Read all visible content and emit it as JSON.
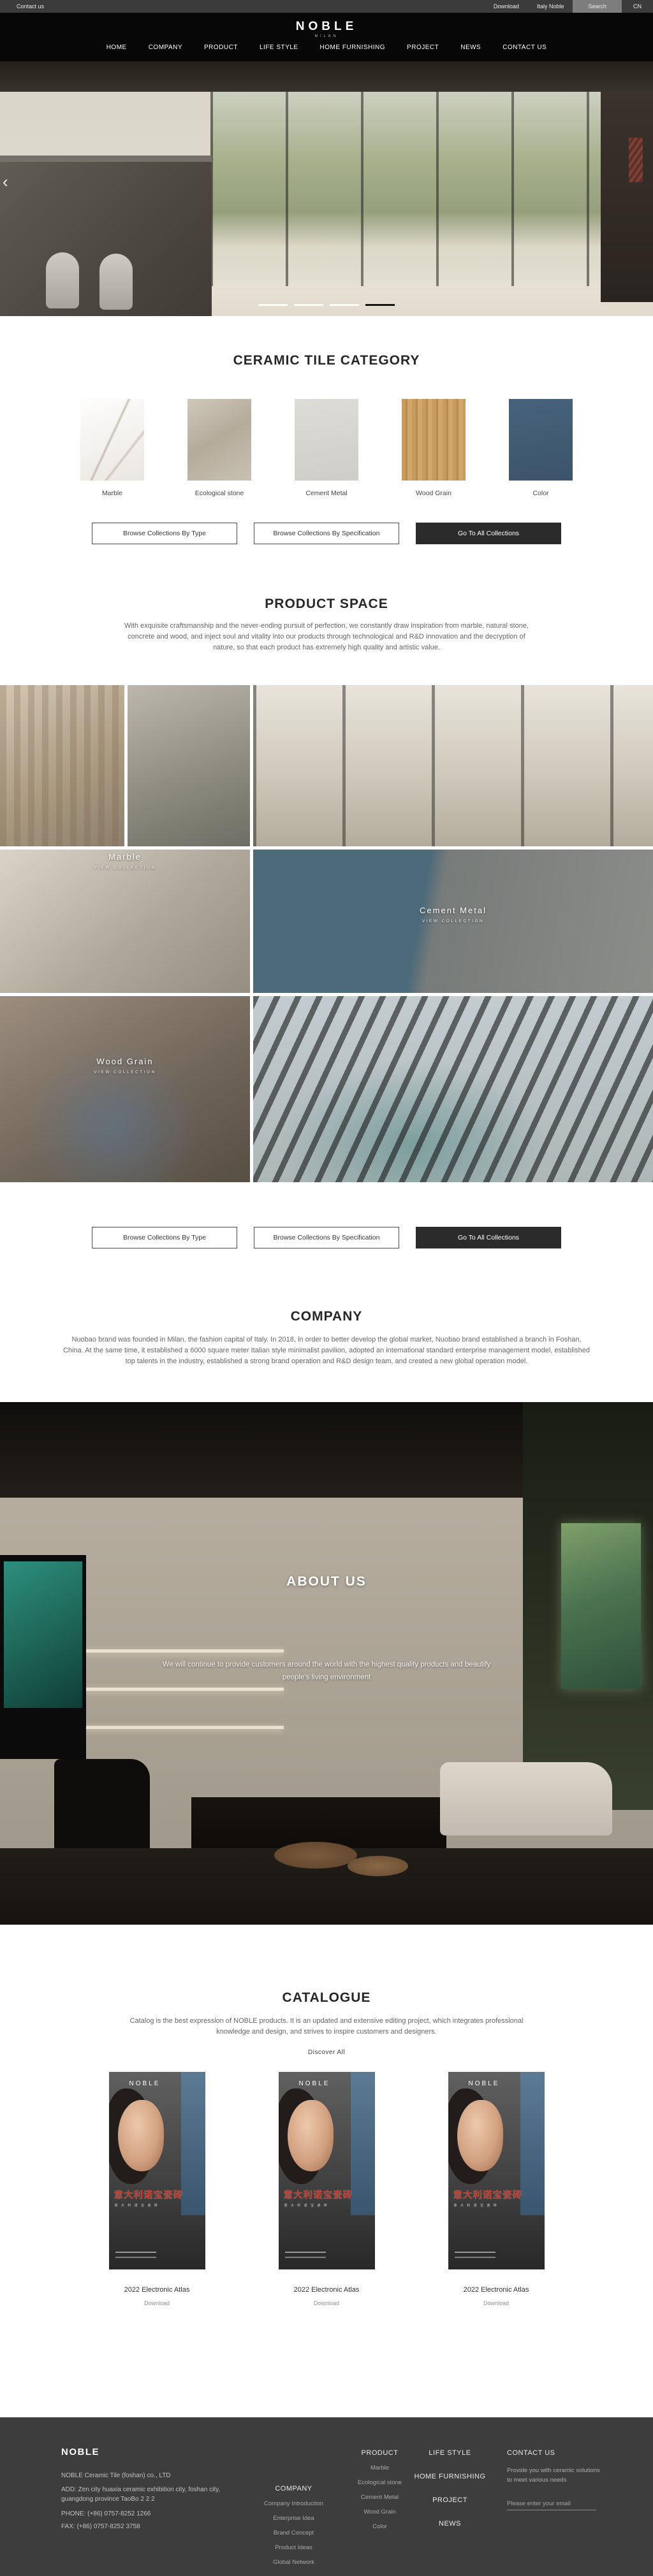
{
  "colors": {
    "accent_dark": "#2b2b2b",
    "footer_bg": "#3d3d3d",
    "cover_blue": "#3e5a77",
    "swatch_blue": "#41596e"
  },
  "topbar": {
    "contact_us": "Contact us",
    "download": "Download",
    "italy_noble": "Italy Noble",
    "search": "Search",
    "language": "CN"
  },
  "header": {
    "logo": "NOBLE",
    "logo_subtitle": "MILAN",
    "nav": [
      "HOME",
      "COMPANY",
      "PRODUCT",
      "LIFE STYLE",
      "HOME FURNISHING",
      "PROJECT",
      "NEWS",
      "CONTACT US"
    ]
  },
  "hero": {
    "prev_arrow": "‹",
    "slide_count": 4,
    "active_slide": 4
  },
  "category": {
    "title": "CERAMIC TILE CATEGORY",
    "items": [
      {
        "label": "Marble"
      },
      {
        "label": "Ecological stone"
      },
      {
        "label": "Cement Metal"
      },
      {
        "label": "Wood Grain"
      },
      {
        "label": "Color"
      }
    ]
  },
  "collection_buttons": {
    "by_type": "Browse Collections By Type",
    "by_spec": "Browse Collections By Specification",
    "all": "Go To All Collections"
  },
  "product_space": {
    "title": "PRODUCT SPACE",
    "description": "With exquisite craftsmanship and the never-ending pursuit of perfection, we constantly draw inspiration from marble, natural stone, concrete and wood, and inject soul and vitality into our products through technological and R&D innovation and the decryption of nature, so that each product has extremely high quality and artistic value.",
    "tiles": [
      {
        "label": "Marble",
        "cta": "VIEW COLLECTION"
      },
      {
        "label": "Cement Metal",
        "cta": "VIEW COLLECTION"
      },
      {
        "label": "Wood Grain",
        "cta": "VIEW COLLECTION"
      }
    ]
  },
  "company": {
    "title": "COMPANY",
    "description": "Nuobao brand was founded in Milan, the fashion capital of Italy. In 2018, in order to better develop the global market, Nuobao brand established a branch in Foshan, China. At the same time, it established a 6000 square meter Italian style minimalist pavilion, adopted an international standard enterprise management model, established top talents in the industry, established a strong brand operation and R&D design team, and created a new global operation model."
  },
  "about": {
    "title": "ABOUT US",
    "description": "We will continue to provide customers around the world with the highest quality products and beautify people's living environment"
  },
  "catalogue": {
    "title": "CATALOGUE",
    "description": "Catalog is the best expression of NOBLE products. It is an updated and extensive editing project, which integrates professional knowledge and design, and strives to inspire customers and designers.",
    "discover_all": "Discover All",
    "cover": {
      "brand": "NOBLE",
      "title": "意大利诺宝瓷砖",
      "subtitle": "意 大 利 诺 宝 瓷 砖"
    },
    "caption": "2022 Electronic Atlas",
    "download_label": "Download"
  },
  "footer": {
    "brand": "NOBLE",
    "company_name": "NOBLE Ceramic Tile (foshan) co., LTD",
    "address": "ADD:  Zen city huaxia ceramic exhibition city, foshan city, guangdong province TaoBo 2 2 2",
    "phone": "PHONE:   (+86)  0757-8252 1266",
    "fax": "FAX:   (+86)  0757-8252 3758",
    "columns": {
      "company": {
        "title": "COMPANY",
        "items": [
          "Company Introduction",
          "Enterprise Idea",
          "Brand Concept",
          "Product Ideas",
          "Global Network"
        ]
      },
      "product": {
        "title": "PRODUCT",
        "items": [
          "Marble",
          "Ecological stone",
          "Cement Metal",
          "Wood Grain",
          "Color"
        ]
      },
      "lifestyle": {
        "items": [
          "LIFE STYLE",
          "HOME FURNISHING",
          "PROJECT",
          "NEWS"
        ]
      },
      "contact": {
        "title": "CONTACT US",
        "blurb": "Provide you with ceramic solutions to meet various needs",
        "email_placeholder": "Please enter your email"
      }
    }
  }
}
